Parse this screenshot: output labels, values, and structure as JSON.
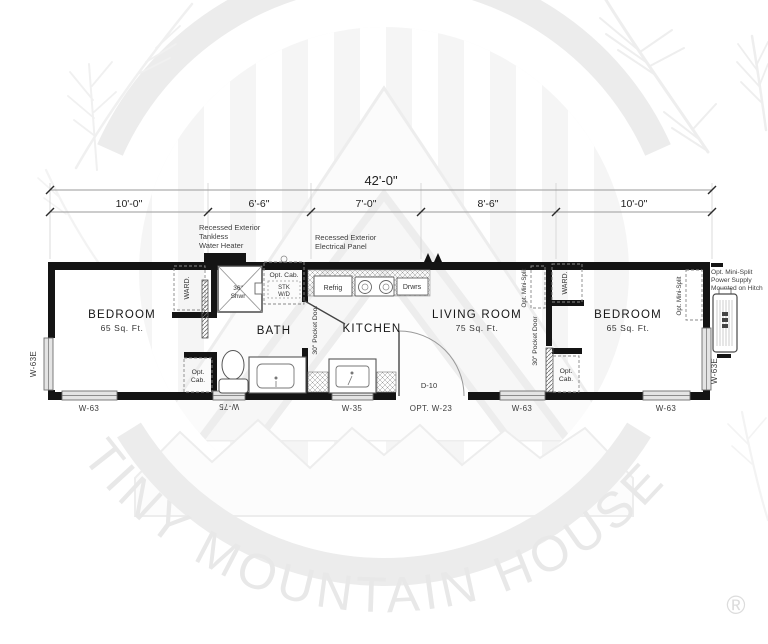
{
  "watermark": {
    "brand": "TINY MOUNTAIN HOUSES",
    "registered": "®"
  },
  "dimensions": {
    "total": "42'-0\"",
    "segments": [
      "10'-0\"",
      "6'-6\"",
      "7'-0\"",
      "8'-6\"",
      "10'-0\""
    ]
  },
  "annotations": {
    "water_heater": [
      "Recessed Exterior",
      "Tankless",
      "Water Heater"
    ],
    "electrical_panel": [
      "Recessed Exterior",
      "Electrical Panel"
    ],
    "hitch_power": [
      "Opt. Mini-Split",
      "Power Supply",
      "Mounted on Hitch"
    ]
  },
  "rooms": {
    "bedroom_left": {
      "name": "BEDROOM",
      "area": "65 Sq. Ft."
    },
    "bath": {
      "name": "BATH"
    },
    "kitchen": {
      "name": "KITCHEN"
    },
    "living_room": {
      "name": "LIVING ROOM",
      "area": "75 Sq. Ft."
    },
    "bedroom_right": {
      "name": "BEDROOM",
      "area": "65 Sq. Ft."
    }
  },
  "fixtures": {
    "wardrobe_left": "WARD.",
    "wardrobe_right": "WARD.",
    "shower": {
      "size": "36\"",
      "label": "Shwr"
    },
    "laundry_cabinet": {
      "line1": "Opt. Cab.",
      "line2": "STK",
      "line3": "W/D"
    },
    "refrigerator": "Refrig",
    "drawers": "Drwrs",
    "opt_cab_bath": {
      "line1": "Opt.",
      "line2": "Cab."
    },
    "opt_cab_bedroom": {
      "line1": "Opt.",
      "line2": "Cab."
    },
    "pocket_door_bath": "30\" Pocket Door",
    "pocket_door_bedroom": "30\" Pocket Door",
    "mini_split_living": "Opt. Mini-Split",
    "mini_split_bedroom": "Opt. Mini-Split"
  },
  "openings": {
    "door": {
      "id": "D-10",
      "option": "OPT. W-23"
    },
    "windows": {
      "left_side": "W-63E",
      "bedroom_left": "W-63",
      "bath": "W-75",
      "kitchen": "W-35",
      "living_room": "W-63",
      "bedroom_right": "W-63",
      "right_side": "W-63E"
    }
  }
}
